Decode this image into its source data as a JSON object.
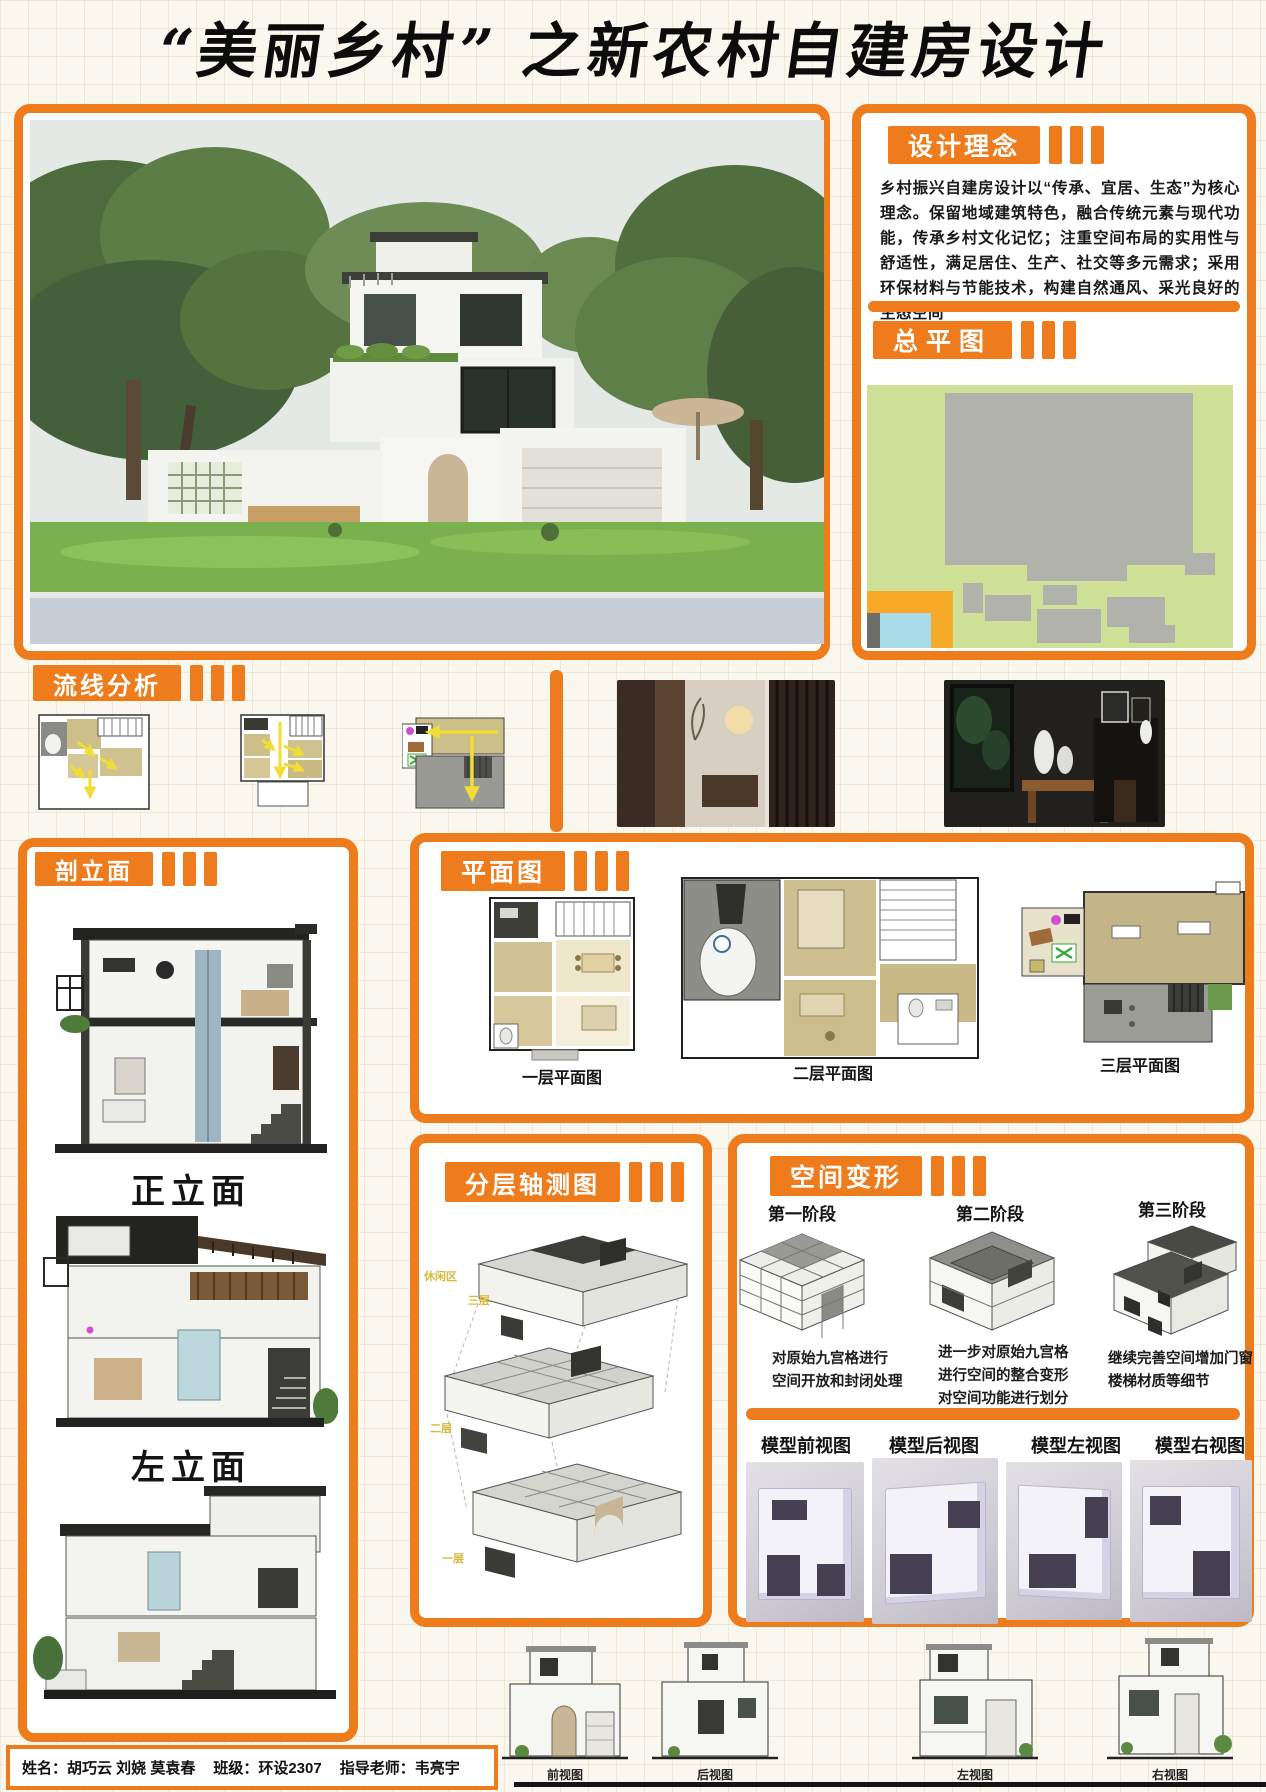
{
  "page": {
    "title": "“美丽乡村” 之新农村自建房设计"
  },
  "colors": {
    "accent_orange": "#ee7c1d",
    "map_orange": "#f7a928",
    "map_green": "#cde096",
    "map_gray": "#b2b2ac",
    "map_cyan": "#a8dce8",
    "arrow_yellow": "#f0dd35",
    "paper": "#faf7ef"
  },
  "design_concept": {
    "heading": "设计理念",
    "body": "乡村振兴自建房设计以“传承、宜居、生态”为核心理念。保留地域建筑特色，融合传统元素与现代功能，传承乡村文化记忆；注重空间布局的实用性与舒适性，满足居住、生产、社交等多元需求；采用环保材料与节能技术，构建自然通风、采光良好的生态空间"
  },
  "master_plan": {
    "heading": "总平图"
  },
  "circulation": {
    "heading": "流线分析"
  },
  "sections": {
    "heading": "剖立面",
    "front_label": "正立面",
    "left_label": "左立面"
  },
  "floor_plans": {
    "heading": "平面图",
    "labels": [
      "一层平面图",
      "二层平面图",
      "三层平面图"
    ]
  },
  "axonometric": {
    "heading": "分层轴测图",
    "tags": [
      "休闲区",
      "三层",
      "二层",
      "一层"
    ]
  },
  "space_transform": {
    "heading": "空间变形",
    "stages": [
      {
        "label": "第一阶段",
        "lines": [
          "对原始九宫格进行",
          "空间开放和封闭处理"
        ]
      },
      {
        "label": "第二阶段",
        "lines": [
          "进一步对原始九宫格",
          "进行空间的整合变形",
          "对空间功能进行划分"
        ]
      },
      {
        "label": "第三阶段",
        "lines": [
          "继续完善空间增加门窗",
          "楼梯材质等细节"
        ]
      }
    ],
    "model_views": [
      "模型前视图",
      "模型后视图",
      "模型左视图",
      "模型右视图"
    ]
  },
  "elevations": {
    "labels": [
      "前视图",
      "后视图",
      "左视图",
      "右视图"
    ]
  },
  "credits": {
    "name_label": "姓名：胡巧云 刘娆 莫袁春",
    "class_label": "班级：环设2307",
    "advisor_label": "指导老师：韦亮宇"
  }
}
